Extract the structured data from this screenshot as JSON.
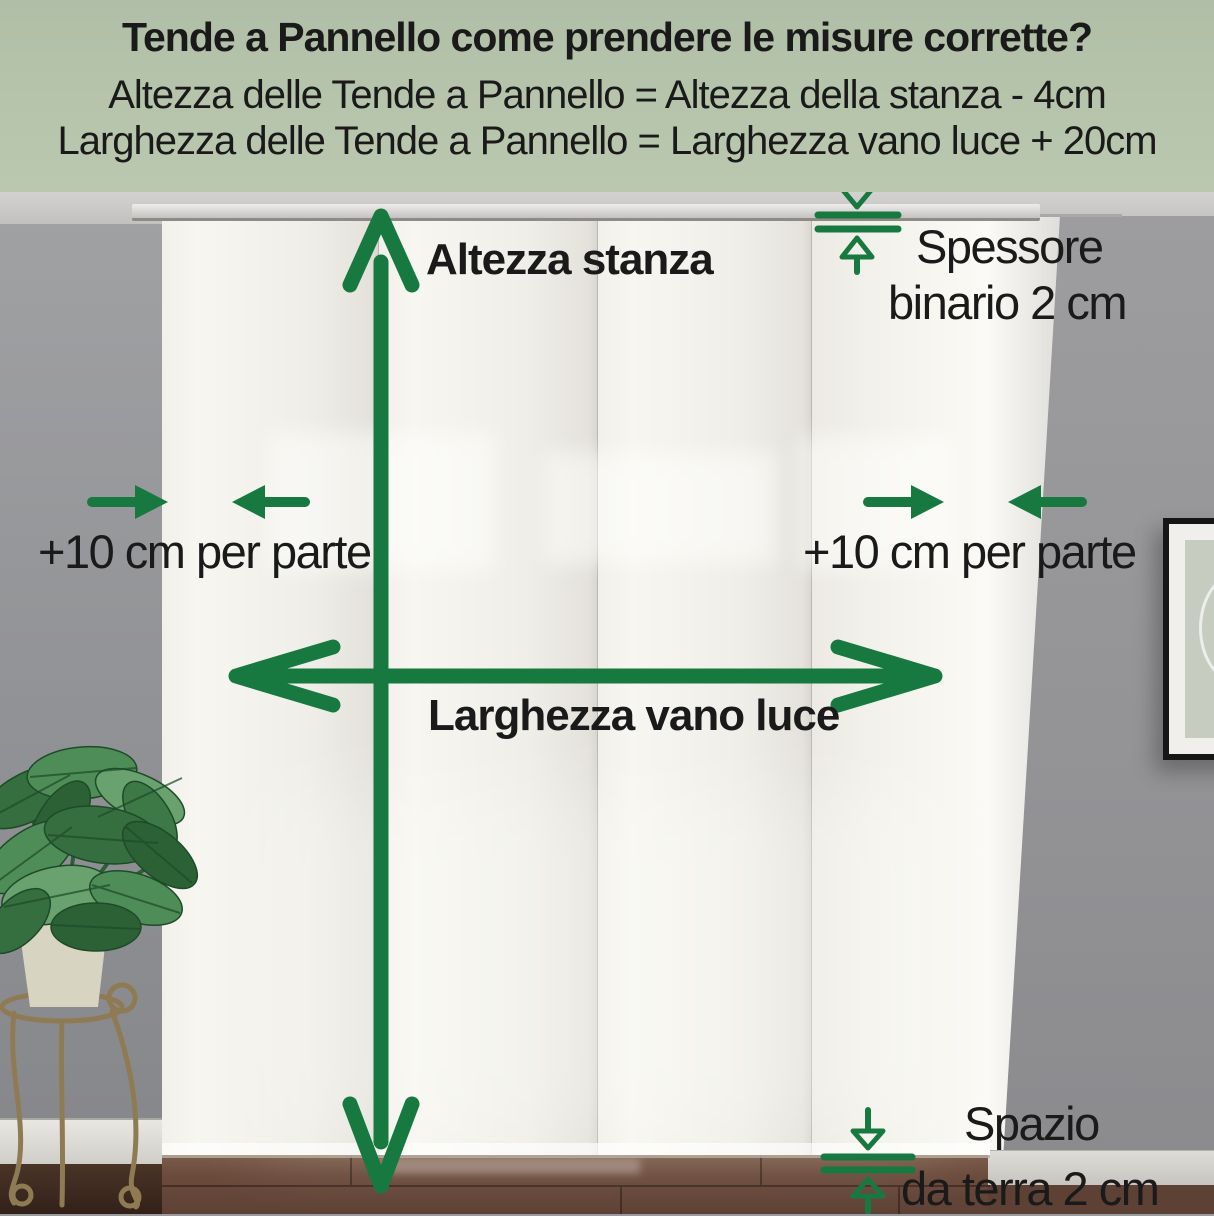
{
  "header": {
    "title": "Tende a Pannello come prendere le misure corrette?",
    "formula_height": "Altezza delle Tende a Pannello = Altezza della stanza - 4cm",
    "formula_width": "Larghezza delle Tende a Pannello = Larghezza vano luce + 20cm"
  },
  "labels": {
    "room_height": "Altezza stanza",
    "opening_width": "Larghezza vano luce",
    "extra_width_left": "+10 cm per parte",
    "extra_width_right": "+10 cm per parte",
    "track_thickness_line1": "Spessore",
    "track_thickness_line2": "binario 2 cm",
    "floor_gap_line1": "Spazio",
    "floor_gap_line2": "da terra 2 cm"
  },
  "colors": {
    "accent_green": "#17793f",
    "header_background": "#b4c3aa",
    "text": "#1a1a1a"
  },
  "scene": {
    "curtain_panel_count": 4
  }
}
